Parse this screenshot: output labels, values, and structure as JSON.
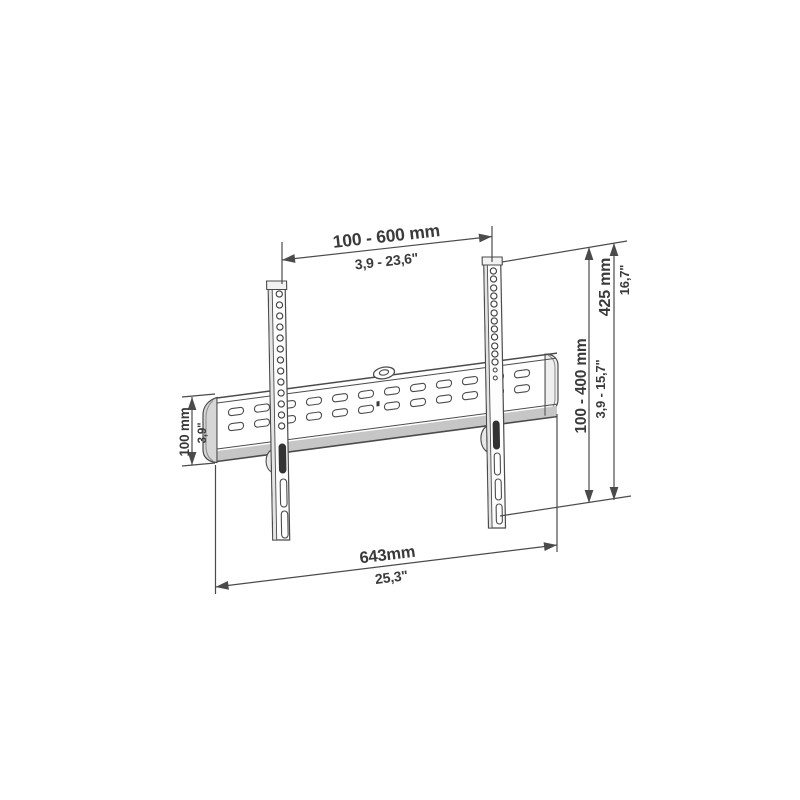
{
  "page": {
    "background": "#ffffff"
  },
  "diagram": {
    "name": "TV wall mount dimensional line drawing",
    "colors": {
      "line": "#4b4b4b",
      "text": "#3a3a3a",
      "shade_light": "#d6d6d6",
      "slot_dark": "#333333"
    },
    "dims": {
      "top_mm": "100 - 600 mm",
      "top_in": "3,9 - 23,6\"",
      "right_outer_mm": "425 mm",
      "right_outer_in": "16,7\"",
      "right_inner_mm": "100 - 400 mm",
      "right_inner_in": "3,9 - 15,7\"",
      "left_mm": "100 mm",
      "left_in": "3,9\"",
      "bottom_mm": "643mm",
      "bottom_in": "25,3\""
    }
  }
}
